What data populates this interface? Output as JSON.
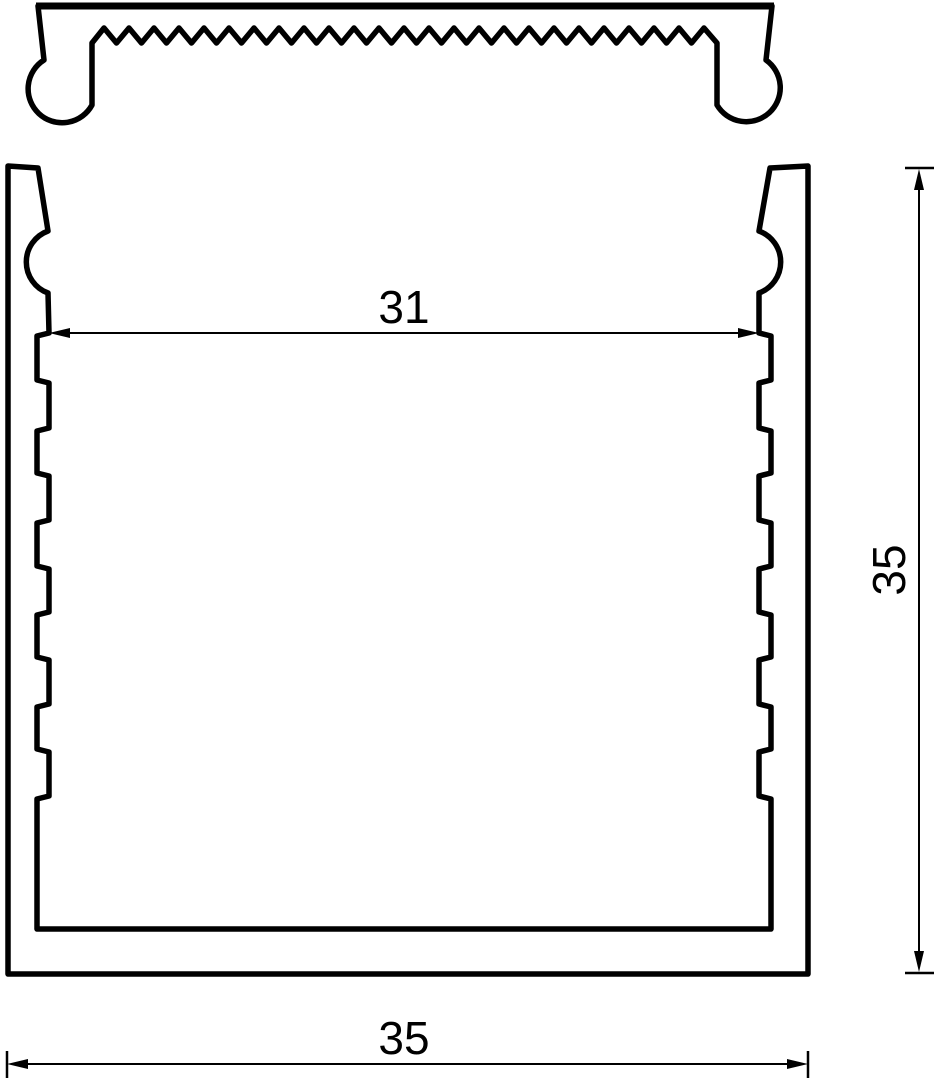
{
  "drawing": {
    "dimension_labels": {
      "inner_width": "31",
      "overall_height": "35",
      "overall_width": "35"
    },
    "colors": {
      "line": "#000000",
      "background": "#ffffff"
    }
  }
}
